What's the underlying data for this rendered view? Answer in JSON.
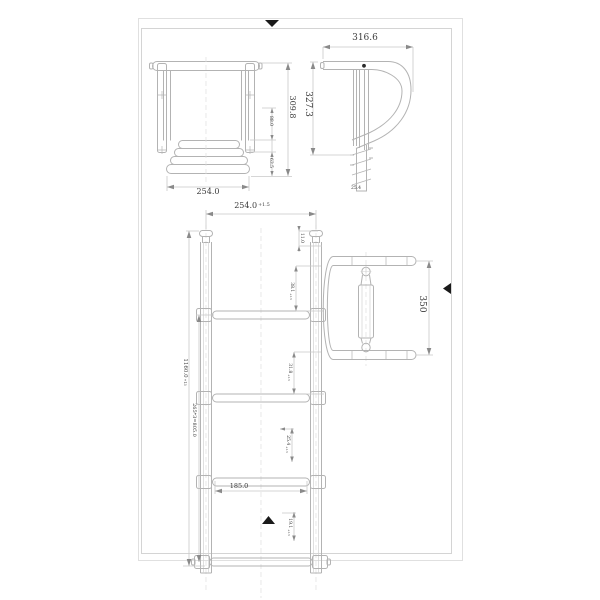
{
  "document": {
    "type": "technical-drawing",
    "subject": "telescoping boat ladder",
    "background": "#ffffff",
    "line_color": "#b3b3b3",
    "dim_line_color": "#c9c9c9",
    "text_color": "#3a3a3a",
    "mark_color": "#1a1a1a"
  },
  "views": {
    "folded_front": {
      "label": "folded front view",
      "dim_width": "254.0",
      "dim_height": "309.8",
      "dim_sub_upper": "88.0",
      "dim_sub_lower": "63.5"
    },
    "folded_side": {
      "label": "folded side view",
      "dim_width": "316.6",
      "dim_height": "327.3",
      "dim_tube": "25.4"
    },
    "extended_front": {
      "label": "extended front view",
      "dim_width_main": "254.0",
      "dim_width_tol": "+1.5",
      "dim_overall_main": "1160.0",
      "dim_overall_tol": "+13",
      "dim_spacing": "265*3=805.0",
      "dim_cap": "11.0",
      "dim_tube1_main": "38.1",
      "dim_tube1_tol": "+1.5",
      "dim_tube2_main": "31.8",
      "dim_tube2_tol": "+1.5",
      "dim_tube3_main": "25.4",
      "dim_tube3_tol": "+1.5",
      "dim_tube4_main": "19.1",
      "dim_tube4_tol": "+1.5",
      "dim_inner": "185.0"
    },
    "handle_top": {
      "label": "handle top view",
      "dim_depth": "350"
    }
  }
}
